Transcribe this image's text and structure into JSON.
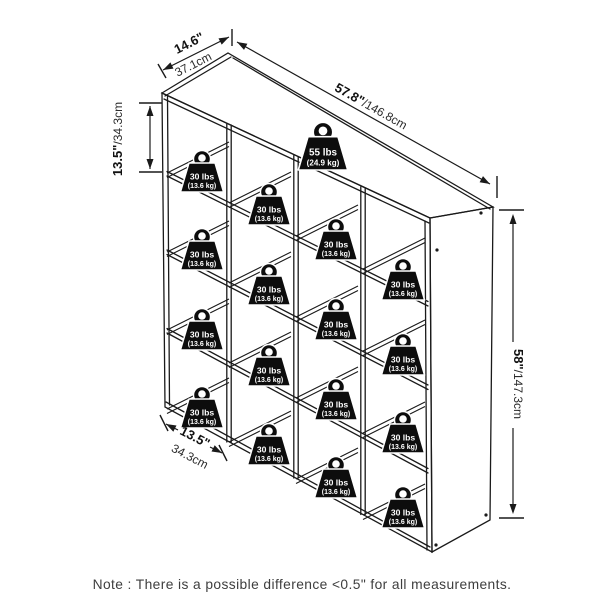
{
  "diagram": {
    "title": "cube-organizer-dimension-diagram",
    "colors": {
      "line": "#1a1a1a",
      "note_text": "#3e3e3e",
      "weight_fill": "#0d0d0d",
      "weight_text": "#ffffff",
      "background": "#ffffff"
    },
    "note": {
      "text": "Note : There is a possible difference <0.5\" for all measurements."
    },
    "dimensions": {
      "depth": {
        "inch": "14.6\"",
        "cm": "37.1cm"
      },
      "width": {
        "inch": "57.8\"",
        "cm": "/146.8cm"
      },
      "cube_height": {
        "inch": "13.5\"",
        "cm": "/34.3cm"
      },
      "height": {
        "inch": "58\"",
        "cm": "/147.3cm"
      },
      "cube_width": {
        "inch": "13.5\"",
        "cm": "34.3cm"
      }
    },
    "weights": {
      "top": {
        "lbs": "55 lbs",
        "kg": "(24.9 kg)",
        "x": 323,
        "y": 170,
        "scale": 1.15
      },
      "cube_label": {
        "lbs": "30 lbs",
        "kg": "(13.6 kg)"
      },
      "cells": [
        {
          "x": 202,
          "y": 192
        },
        {
          "x": 269,
          "y": 225
        },
        {
          "x": 336,
          "y": 260
        },
        {
          "x": 403,
          "y": 300
        },
        {
          "x": 202,
          "y": 270
        },
        {
          "x": 269,
          "y": 305
        },
        {
          "x": 336,
          "y": 340
        },
        {
          "x": 403,
          "y": 375
        },
        {
          "x": 202,
          "y": 350
        },
        {
          "x": 269,
          "y": 386
        },
        {
          "x": 336,
          "y": 420
        },
        {
          "x": 403,
          "y": 453
        },
        {
          "x": 202,
          "y": 428
        },
        {
          "x": 269,
          "y": 465
        },
        {
          "x": 336,
          "y": 498
        },
        {
          "x": 403,
          "y": 528
        }
      ]
    }
  }
}
